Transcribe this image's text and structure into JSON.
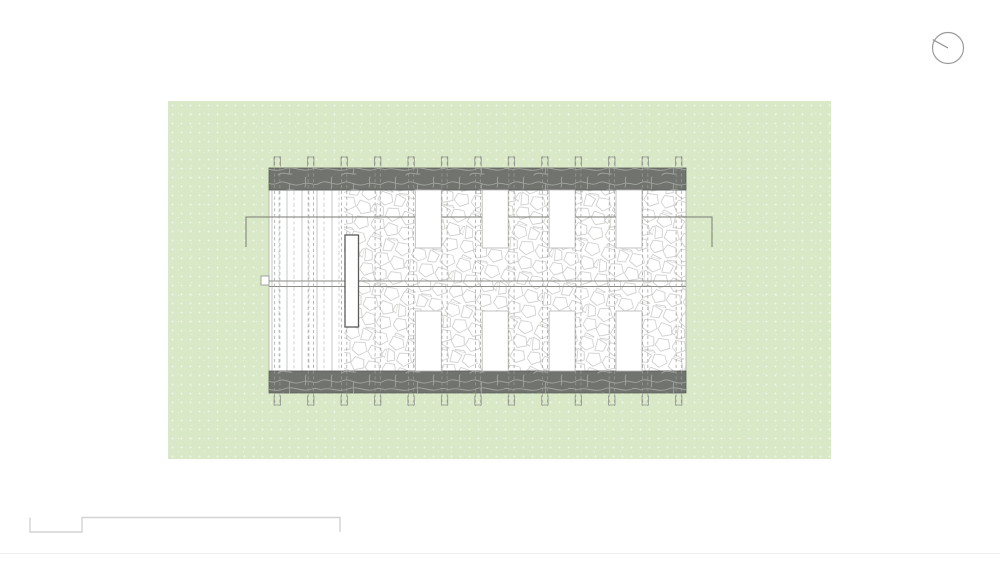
{
  "page": {
    "background": "#ffffff",
    "width": 1000,
    "height": 563
  },
  "site": {
    "x": 168,
    "y": 101,
    "width": 663,
    "height": 358,
    "fill": "#d9e8c6"
  },
  "north_indicator": {
    "icon": "north-dial-icon",
    "cx": 948,
    "cy": 48,
    "r": 15.5,
    "needle_dx": -15.2,
    "needle_dy": -8.4,
    "stroke": "#9b9b9b",
    "needle_stroke": "#8e8e8e"
  },
  "scale_bar": {
    "points": "30,517.5 30,532 82,532 82,517.5 340,517.5 340,532",
    "color": "#d3d3d3"
  },
  "sheet_divider": {
    "y": 553,
    "color": "#efefef"
  },
  "plan": {
    "building": {
      "x": 269,
      "y": 168,
      "width": 417,
      "height": 225
    },
    "bands": {
      "height": 22,
      "fill": "#70736e",
      "stone_stroke": "#a2a5a0",
      "border": "#5c5f5a"
    },
    "interior": {
      "top": 190,
      "bottom": 371,
      "fill": "#ffffff",
      "border": "#b0b2ae"
    },
    "deck": {
      "x1": 269,
      "x2": 344,
      "line_color": "#c0c2be",
      "dash_color": "#c6c8c4"
    },
    "stone": {
      "x1": 344,
      "x2": 686,
      "line_color": "#c6c8c4"
    },
    "grid": {
      "start_x": 277.3,
      "spacing": 33.45,
      "count": 13,
      "pair_gap": 5.2,
      "dash_color": "#9a9d98",
      "tick_color": "#8f928d",
      "y_top": 156,
      "y_bottom": 406,
      "tick_top_cap": 157,
      "tick_top_end": 166.5,
      "tick_bottom_cap": 405,
      "tick_bottom_end": 395.5,
      "tick_half_width": 3.2
    },
    "rooms": {
      "fill": "#ffffff",
      "stroke": "#b3b5b1",
      "width": 26,
      "top_row_y": 190,
      "top_row_h": 58,
      "bottom_row_y": 311,
      "bottom_row_h": 60,
      "left_edges": [
        415.3,
        482.2,
        549.1,
        616.0
      ]
    },
    "bench": {
      "x": 345,
      "y": 235,
      "width": 13.5,
      "height": 92,
      "stroke": "#5a5d58",
      "fill": "#ffffff"
    },
    "section_line": {
      "y": 217,
      "x1": 246,
      "x2": 712,
      "drop": 30,
      "color": "#787b74"
    },
    "walkway_lines": {
      "y1": 281,
      "y2": 286.5,
      "color": "#8b8e89"
    },
    "door_marker": {
      "x": 261,
      "y": 276,
      "width": 8,
      "height": 9,
      "color": "#8b8e89",
      "fill": "#ffffff"
    }
  }
}
